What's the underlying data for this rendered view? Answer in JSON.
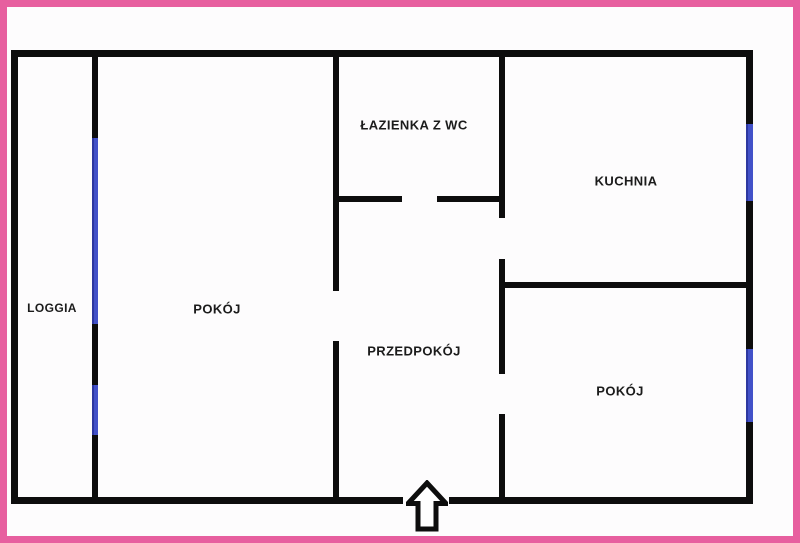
{
  "title": "Apartment floor plan",
  "palette": {
    "border_pink": "#e75f9f",
    "wall_black": "#0d0d0d",
    "window_blue": "#4251c8",
    "background": "#fdfcfd",
    "text": "#1b1b1b"
  },
  "rooms": [
    {
      "id": "loggia",
      "label": "LOGGIA"
    },
    {
      "id": "pokoj-left",
      "label": "POKÓJ"
    },
    {
      "id": "lazienka",
      "label": "ŁAZIENKA Z WC"
    },
    {
      "id": "kuchnia",
      "label": "KUCHNIA"
    },
    {
      "id": "przedpokoj",
      "label": "PRZEDPOKÓJ"
    },
    {
      "id": "pokoj-right",
      "label": "POKÓJ"
    }
  ],
  "icons": {
    "entrance_arrow": "hollow-up-arrow"
  },
  "windows_count": 4,
  "door_gaps_count": 5
}
